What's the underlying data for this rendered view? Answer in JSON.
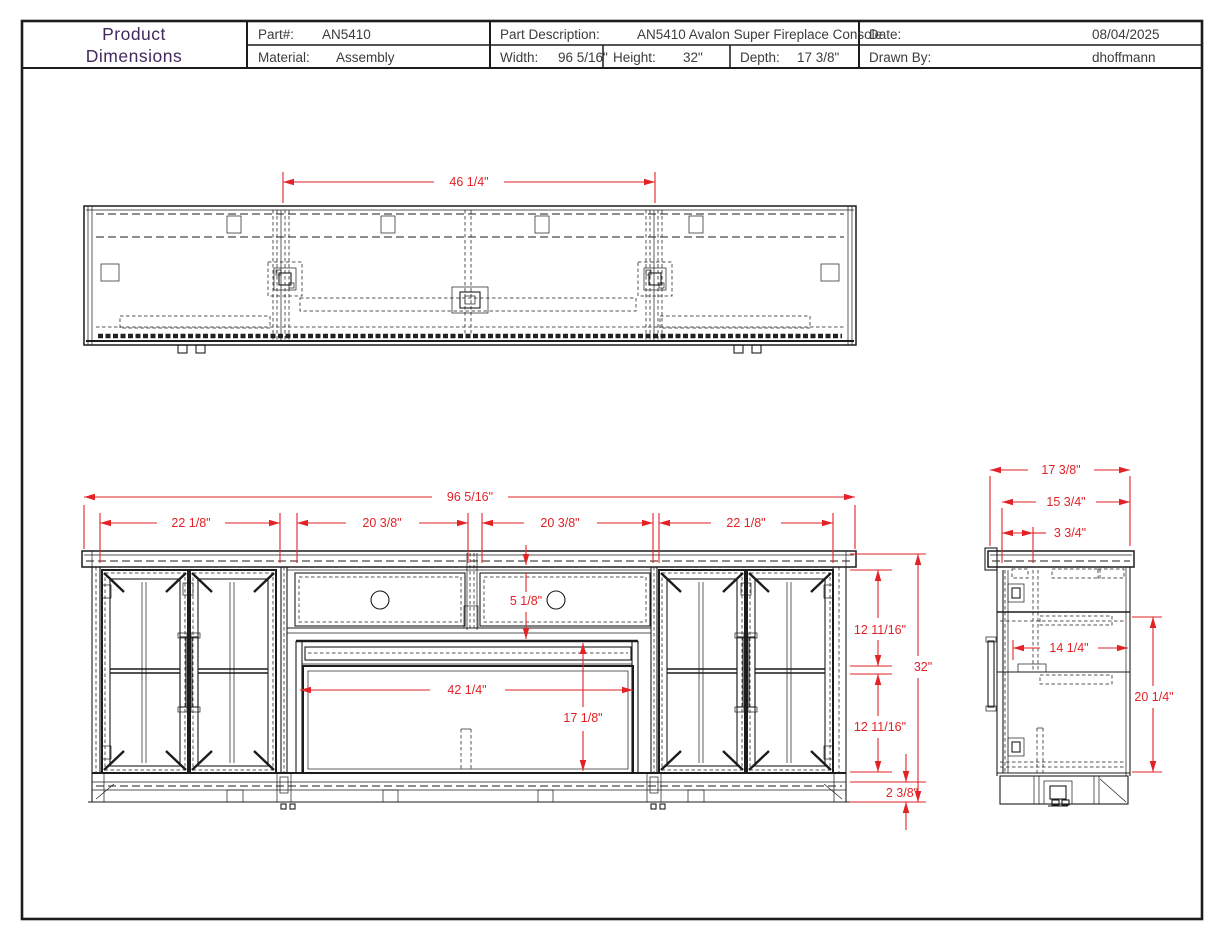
{
  "colors": {
    "dimension_red": "#e32227",
    "title_purple": "#41295c",
    "line_black": "#1c1c1c"
  },
  "title_block": {
    "title_lines": [
      "Product",
      "Dimensions"
    ],
    "part": {
      "label": "Part#:",
      "value": "AN5410"
    },
    "material": {
      "label": "Material:",
      "value": "Assembly"
    },
    "description": {
      "label": "Part Description:",
      "value": "AN5410 Avalon Super Fireplace Console"
    },
    "width": {
      "label": "Width:",
      "value": "96 5/16\""
    },
    "height": {
      "label": "Height:",
      "value": "32\""
    },
    "depth": {
      "label": "Depth:",
      "value": "17 3/8\""
    },
    "date": {
      "label": "Date:",
      "value": "08/04/2025"
    },
    "drawn_by": {
      "label": "Drawn By:",
      "value": "dhoffmann"
    }
  },
  "dimensions": {
    "top_view": {
      "center_section_width": "46 1/4\""
    },
    "front_view": {
      "overall_width": "96 5/16\"",
      "left_door_section_width": "22 1/8\"",
      "left_drawer_width": "20 3/8\"",
      "right_drawer_width": "20 3/8\"",
      "right_door_section_width": "22 1/8\"",
      "drawer_height": "5 1/8\"",
      "fireplace_opening_width": "42 1/4\"",
      "fireplace_opening_height": "17 1/8\"",
      "upper_section_height": "12 11/16\"",
      "lower_section_height": "12 11/16\"",
      "overall_height": "32\"",
      "base_height": "2 3/8\""
    },
    "side_view": {
      "overall_depth": "17 3/8\"",
      "interior_depth": "15 3/4\"",
      "top_offset": "3 3/4\"",
      "shelf_depth": "14 1/4\"",
      "opening_height": "20 1/4\""
    }
  }
}
